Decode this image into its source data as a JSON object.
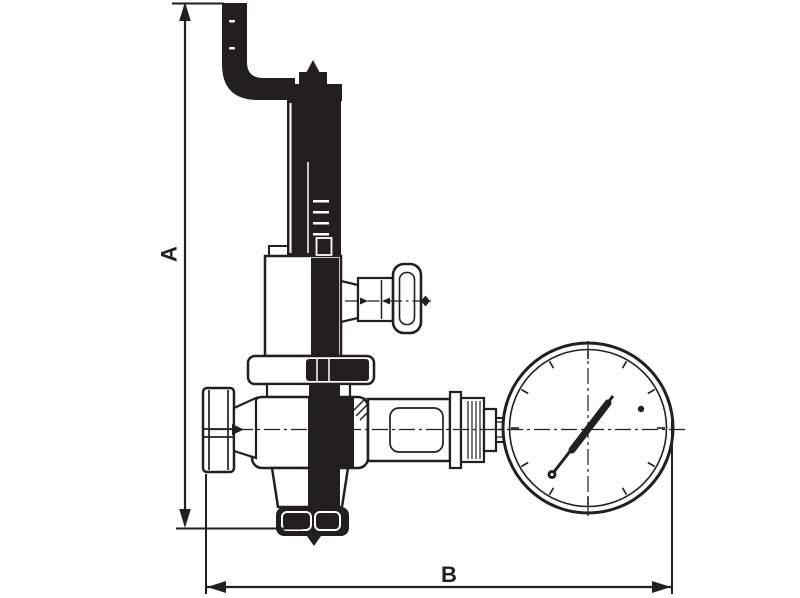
{
  "drawing": {
    "kind": "technical-line-drawing",
    "subject": "safety relief valve with lever, side handwheel and pressure gauge"
  },
  "colors": {
    "ink": "#231f20",
    "background": "#ffffff"
  },
  "dimensions": {
    "vertical": {
      "label": "A"
    },
    "horizontal": {
      "label": "B"
    }
  },
  "parts": [
    "lever-handle",
    "adjusting-screw",
    "spring-column",
    "spring-housing",
    "housing-flange",
    "valve-body",
    "inlet-union",
    "inlet-cone",
    "outlet-connection",
    "test-handwheel",
    "gauge-piping",
    "pressure-gauge",
    "gauge-needle",
    "centerlines"
  ]
}
